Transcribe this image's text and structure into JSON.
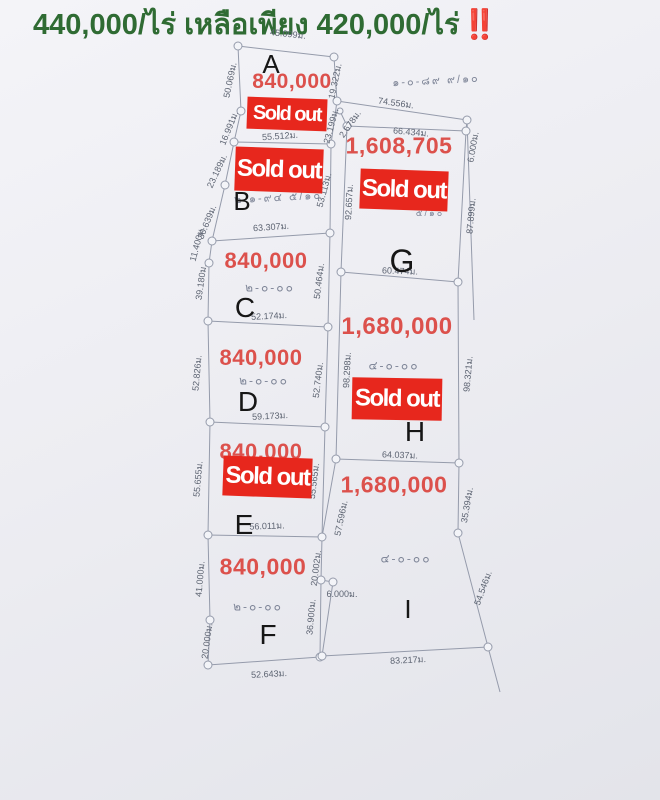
{
  "header": {
    "promo_text": "440,000/ไร่ เหลือเพียง 420,000/ไร่",
    "emphasis": "‼️"
  },
  "sold_out_label": "Sold out",
  "colors": {
    "promo_green": "#2f6b33",
    "alert_red": "#e02b20",
    "price_red": "#dc514c",
    "banner_red": "#e7271d",
    "boundary_line": "#959bab",
    "measure_text": "#5d6472",
    "area_text": "#808799",
    "letter_black": "#161616",
    "paper": "#ebecf1"
  },
  "plots": [
    {
      "id": "A",
      "letter": {
        "t": "A",
        "x": 271,
        "y": 64,
        "fs": 26
      },
      "price": {
        "t": "840,000",
        "x": 292,
        "y": 82,
        "fs": 21
      },
      "sold_out": {
        "x": 247,
        "y": 98,
        "w": 80,
        "h": 32,
        "r": 2,
        "fs": 20
      }
    },
    {
      "id": "B",
      "letter": {
        "t": "B",
        "x": 242,
        "y": 201,
        "fs": 26
      },
      "price": null,
      "sold_out": {
        "x": 235,
        "y": 148,
        "w": 88,
        "h": 44,
        "r": 2,
        "fs": 24
      }
    },
    {
      "id": "C",
      "letter": {
        "t": "C",
        "x": 245,
        "y": 308,
        "fs": 28
      },
      "price": {
        "t": "840,000",
        "x": 266,
        "y": 261,
        "fs": 22
      },
      "sold_out": null
    },
    {
      "id": "D",
      "letter": {
        "t": "D",
        "x": 248,
        "y": 402,
        "fs": 28
      },
      "price": {
        "t": "840,000",
        "x": 261,
        "y": 358,
        "fs": 22
      },
      "sold_out": null
    },
    {
      "id": "E",
      "letter": {
        "t": "E",
        "x": 244,
        "y": 525,
        "fs": 28
      },
      "price": {
        "t": "840,000",
        "x": 261,
        "y": 452,
        "fs": 22
      },
      "sold_out": {
        "x": 223,
        "y": 457,
        "w": 89,
        "h": 40,
        "r": 2,
        "fs": 24
      }
    },
    {
      "id": "F",
      "letter": {
        "t": "F",
        "x": 268,
        "y": 635,
        "fs": 28
      },
      "price": {
        "t": "840,000",
        "x": 263,
        "y": 567,
        "fs": 23
      },
      "sold_out": null
    },
    {
      "id": "G",
      "letter": {
        "t": "G",
        "x": 402,
        "y": 261,
        "fs": 32
      },
      "price": {
        "t": "1,608,705",
        "x": 399,
        "y": 146,
        "fs": 23
      },
      "sold_out": {
        "x": 360,
        "y": 170,
        "w": 88,
        "h": 40,
        "r": 2,
        "fs": 24
      }
    },
    {
      "id": "H",
      "letter": {
        "t": "H",
        "x": 415,
        "y": 432,
        "fs": 28
      },
      "price": {
        "t": "1,680,000",
        "x": 397,
        "y": 327,
        "fs": 24
      },
      "sold_out": {
        "x": 352,
        "y": 378,
        "w": 90,
        "h": 42,
        "r": 1,
        "fs": 24
      }
    },
    {
      "id": "I",
      "letter": {
        "t": "I",
        "x": 408,
        "y": 609,
        "fs": 26
      },
      "price": {
        "t": "1,680,000",
        "x": 394,
        "y": 485,
        "fs": 23
      },
      "sold_out": null
    }
  ],
  "area_notations": [
    {
      "plot": "north-parcel",
      "t": "๑-๐-๘๙ ๙/๑๐",
      "x": 436,
      "y": 80,
      "r": -3,
      "fs": 11
    },
    {
      "plot": "B",
      "t": "๒-๑-๙๔ ๕/๑๐",
      "x": 278,
      "y": 197,
      "r": -3,
      "fs": 11
    },
    {
      "plot": "C",
      "t": "๒-๐-๐๐",
      "x": 270,
      "y": 288,
      "r": 0,
      "fs": 12
    },
    {
      "plot": "D",
      "t": "๒-๐-๐๐",
      "x": 264,
      "y": 381,
      "r": 0,
      "fs": 12
    },
    {
      "plot": "F",
      "t": "๒-๐-๐๐",
      "x": 258,
      "y": 607,
      "r": 0,
      "fs": 12
    },
    {
      "plot": "G",
      "t": "๕/๑๐",
      "x": 430,
      "y": 213,
      "r": 0,
      "fs": 9
    },
    {
      "plot": "H",
      "t": "๔-๐-๐๐",
      "x": 394,
      "y": 366,
      "r": 0,
      "fs": 12
    },
    {
      "plot": "I",
      "t": "๔-๐-๐๐",
      "x": 406,
      "y": 559,
      "r": 0,
      "fs": 12
    }
  ],
  "measurements": [
    {
      "t": "45.099ม.",
      "x": 288,
      "y": 34,
      "r": 6
    },
    {
      "t": "50.069ม.",
      "x": 230,
      "y": 80,
      "r": -78
    },
    {
      "t": "16.991ม.",
      "x": 229,
      "y": 128,
      "r": -68
    },
    {
      "t": "23.189ม.",
      "x": 217,
      "y": 171,
      "r": -65
    },
    {
      "t": "30.639ม.",
      "x": 207,
      "y": 222,
      "r": -68
    },
    {
      "t": "11.400ม.",
      "x": 197,
      "y": 244,
      "r": -75
    },
    {
      "t": "39.180ม.",
      "x": 201,
      "y": 282,
      "r": -82
    },
    {
      "t": "52.826ม.",
      "x": 197,
      "y": 373,
      "r": -85
    },
    {
      "t": "55.655ม.",
      "x": 198,
      "y": 479,
      "r": -85
    },
    {
      "t": "41.000ม.",
      "x": 200,
      "y": 579,
      "r": -85
    },
    {
      "t": "20.000ม.",
      "x": 207,
      "y": 641,
      "r": -82
    },
    {
      "t": "55.512ม.",
      "x": 280,
      "y": 136,
      "r": -4
    },
    {
      "t": "19.322ม.",
      "x": 335,
      "y": 81,
      "r": -78
    },
    {
      "t": "23.199ม.",
      "x": 331,
      "y": 126,
      "r": -75
    },
    {
      "t": "53.113ม.",
      "x": 324,
      "y": 190,
      "r": -75
    },
    {
      "t": "63.307ม.",
      "x": 271,
      "y": 227,
      "r": -4
    },
    {
      "t": "50.464ม.",
      "x": 319,
      "y": 281,
      "r": -83
    },
    {
      "t": "52.174ม.",
      "x": 269,
      "y": 316,
      "r": -3
    },
    {
      "t": "52.740ม.",
      "x": 318,
      "y": 380,
      "r": -83
    },
    {
      "t": "59.173ม.",
      "x": 270,
      "y": 416,
      "r": -3
    },
    {
      "t": "55.565ม.",
      "x": 314,
      "y": 481,
      "r": -83
    },
    {
      "t": "56.011ม.",
      "x": 267,
      "y": 526,
      "r": -2
    },
    {
      "t": "20.002ม.",
      "x": 316,
      "y": 568,
      "r": -83
    },
    {
      "t": "36.900ม.",
      "x": 311,
      "y": 617,
      "r": -85
    },
    {
      "t": "52.643ม.",
      "x": 269,
      "y": 674,
      "r": -3
    },
    {
      "t": "74.556ม.",
      "x": 396,
      "y": 103,
      "r": 8
    },
    {
      "t": "2.678ม.",
      "x": 350,
      "y": 124,
      "r": -55
    },
    {
      "t": "66.434ม.",
      "x": 411,
      "y": 132,
      "r": 5
    },
    {
      "t": "6.000ม.",
      "x": 473,
      "y": 147,
      "r": -80
    },
    {
      "t": "92.657ม.",
      "x": 349,
      "y": 202,
      "r": -87
    },
    {
      "t": "87.899ม.",
      "x": 471,
      "y": 216,
      "r": -85
    },
    {
      "t": "60.474ม.",
      "x": 400,
      "y": 271,
      "r": 2
    },
    {
      "t": "98.298ม.",
      "x": 347,
      "y": 370,
      "r": -87
    },
    {
      "t": "98.321ม.",
      "x": 468,
      "y": 374,
      "r": -85
    },
    {
      "t": "64.037ม.",
      "x": 400,
      "y": 455,
      "r": 2
    },
    {
      "t": "57.596ม.",
      "x": 341,
      "y": 518,
      "r": -78
    },
    {
      "t": "35.394ม.",
      "x": 467,
      "y": 505,
      "r": -80
    },
    {
      "t": "54.546ม.",
      "x": 483,
      "y": 588,
      "r": -70
    },
    {
      "t": "6.000ม.",
      "x": 342,
      "y": 594,
      "r": 0
    },
    {
      "t": "83.217ม.",
      "x": 408,
      "y": 660,
      "r": -3
    }
  ]
}
